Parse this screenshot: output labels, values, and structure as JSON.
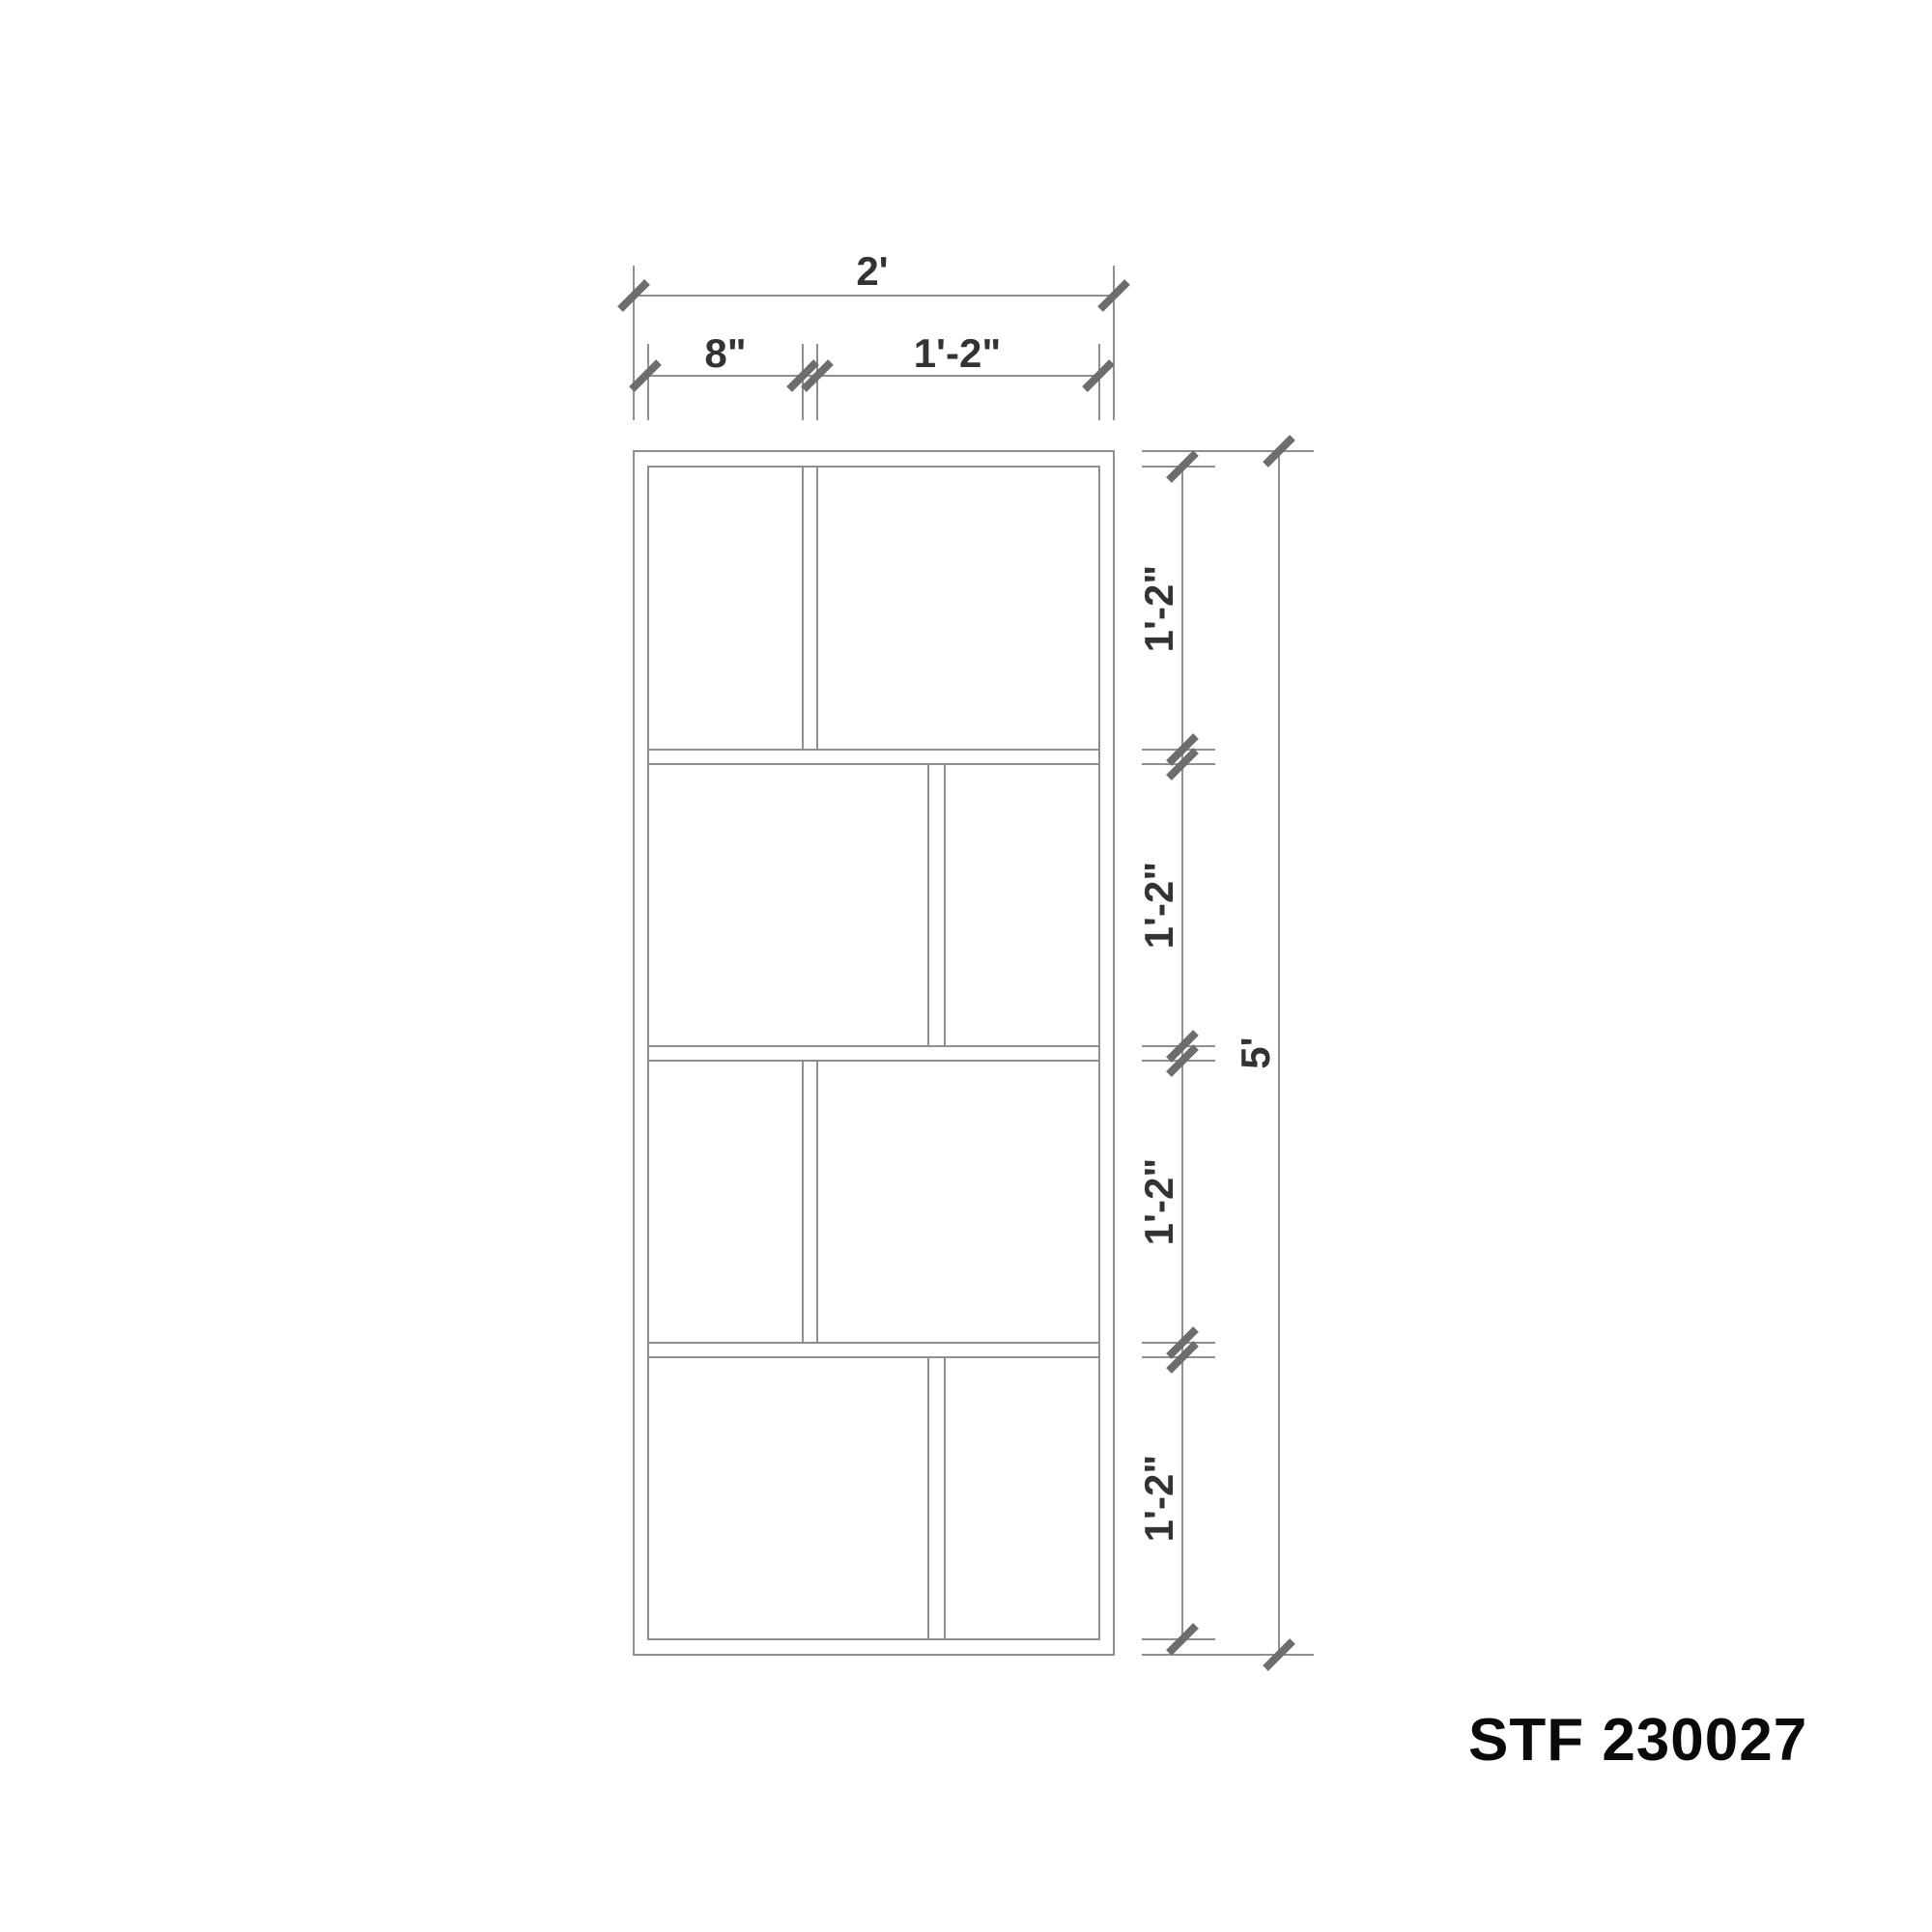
{
  "drawing": {
    "type": "furniture-elevation",
    "product_code": "STF 230027",
    "dims": {
      "overall_width": "2'",
      "top_segment_left": "8\"",
      "top_segment_right": "1'-2\"",
      "rows": [
        "1'-2\"",
        "1'-2\"",
        "1'-2\"",
        "1'-2\""
      ],
      "overall_height": "5'"
    },
    "structure": {
      "rows_count": 4,
      "divider_position_by_row": [
        "left",
        "right",
        "left",
        "right"
      ]
    },
    "colors": {
      "line": "#8f8f8f",
      "tick": "#6d6d6d",
      "dim_text": "#333333",
      "code_text": "#0a0a0a",
      "background": "#ffffff"
    }
  }
}
